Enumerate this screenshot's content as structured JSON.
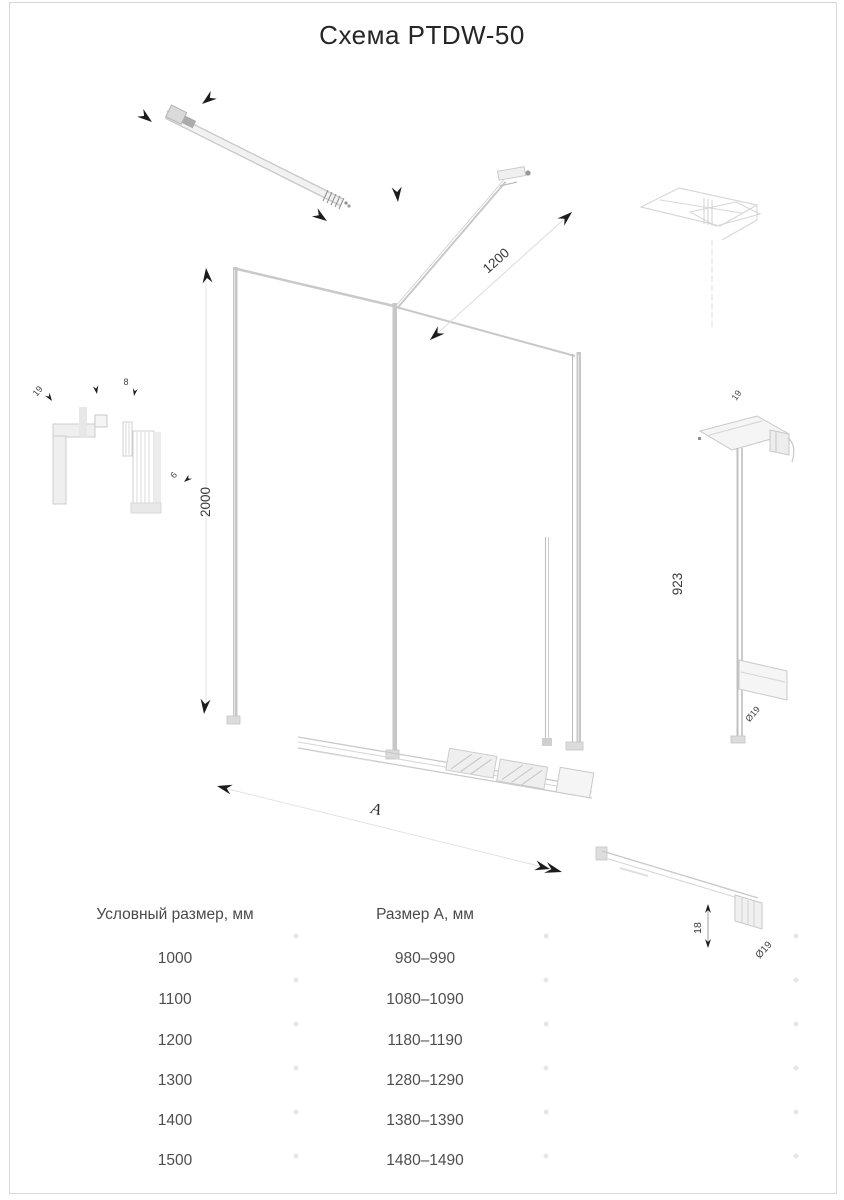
{
  "title": "Схема PTDW-50",
  "drawing": {
    "labels": {
      "height": "2000",
      "strut_length": "1200",
      "profile_height": "923",
      "width_label": "A",
      "left_detail_top": "19",
      "left_detail_glass": "8",
      "left_detail_gap": "6",
      "right_detail_top": "19",
      "right_detail_bottom": "Ø19",
      "rail_detail_height": "18",
      "rail_detail_diameter": "Ø19"
    }
  },
  "table": {
    "headers": {
      "nominal": "Условный размер, мм",
      "size_a": "Размер А, мм"
    },
    "rows": [
      {
        "nominal": "1000",
        "size_a": "980–990"
      },
      {
        "nominal": "1100",
        "size_a": "1080–1090"
      },
      {
        "nominal": "1200",
        "size_a": "1180–1190"
      },
      {
        "nominal": "1300",
        "size_a": "1280–1290"
      },
      {
        "nominal": "1400",
        "size_a": "1380–1390"
      },
      {
        "nominal": "1500",
        "size_a": "1480–1490"
      }
    ]
  },
  "colors": {
    "line_light": "#c9c9c9",
    "ink": "#1c1c1c",
    "dim_text": "#3a3a3a"
  }
}
